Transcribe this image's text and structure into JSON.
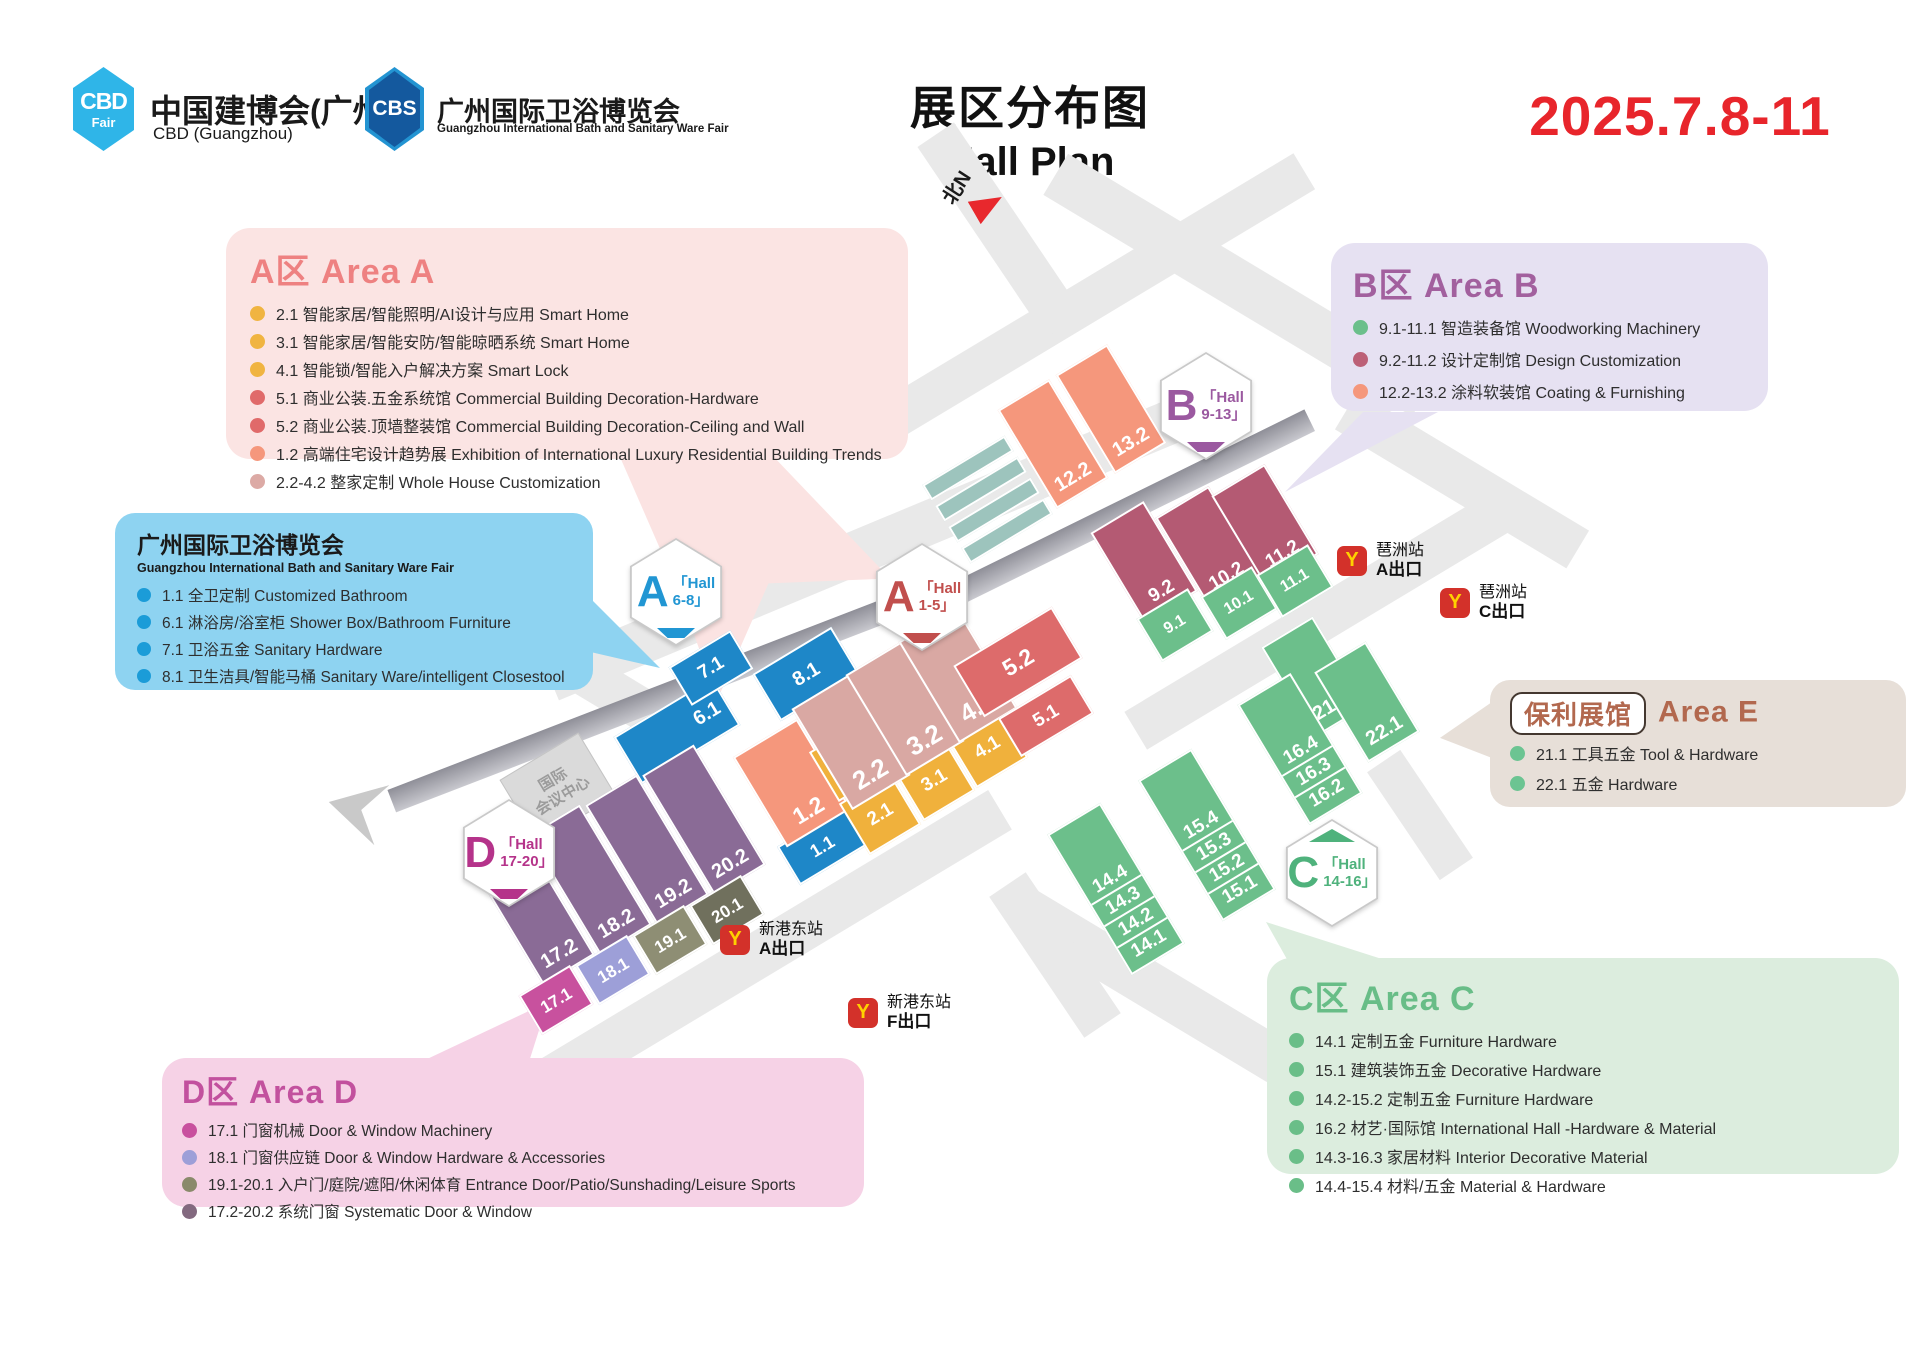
{
  "header": {
    "logo_cbd": {
      "line1": "CBD",
      "line2": "Fair",
      "title": "中国建博会(广州)",
      "subtitle": "CBD (Guangzhou)"
    },
    "logo_cbs": {
      "line1": "CBS",
      "title": "广州国际卫浴博览会",
      "subtitle": "Guangzhou International Bath and Sanitary Ware Fair"
    },
    "title_cn": "展区分布图",
    "title_en": "Hall Plan",
    "date": "2025.7.8-11"
  },
  "areas": [
    {
      "title": "A区 Area A",
      "title_color": "#ee8181",
      "bg": "#fbe4e3",
      "items": [
        {
          "dot": "#f0b441",
          "text": "2.1 智能家居/智能照明/AI设计与应用 Smart Home"
        },
        {
          "dot": "#f0b441",
          "text": "3.1 智能家居/智能安防/智能晾晒系统 Smart Home"
        },
        {
          "dot": "#f0b441",
          "text": "4.1 智能锁/智能入户解决方案 Smart Lock"
        },
        {
          "dot": "#e06a6a",
          "text": "5.1 商业公装.五金系统馆 Commercial Building Decoration-Hardware"
        },
        {
          "dot": "#e06a6a",
          "text": "5.2 商业公装.顶墙整装馆 Commercial Building Decoration-Ceiling and Wall"
        },
        {
          "dot": "#f5977c",
          "text": "1.2 高端住宅设计趋势展 Exhibition of International Luxury Residential Building Trends"
        },
        {
          "dot": "#dcaaa5",
          "text": "2.2-4.2 整家定制 Whole House Customization"
        }
      ]
    },
    {
      "title": "广州国际卫浴博览会",
      "subtitle": "Guangzhou International Bath and Sanitary Ware Fair",
      "title_color": "#1a1a1a",
      "bg": "#8ed3f1",
      "items": [
        {
          "dot": "#1b9cd8",
          "text": "1.1 全卫定制 Customized Bathroom"
        },
        {
          "dot": "#1b9cd8",
          "text": "6.1 淋浴房/浴室柜 Shower Box/Bathroom Furniture"
        },
        {
          "dot": "#1b9cd8",
          "text": "7.1 卫浴五金 Sanitary Hardware"
        },
        {
          "dot": "#1b9cd8",
          "text": "8.1 卫生洁具/智能马桶 Sanitary Ware/intelligent Closestool"
        }
      ]
    },
    {
      "title": "B区 Area B",
      "title_color": "#a2609e",
      "bg": "#e6e1f2",
      "items": [
        {
          "dot": "#6bbf8b",
          "text": "9.1-11.1 智造装备馆 Woodworking Machinery"
        },
        {
          "dot": "#bc6077",
          "text": "9.2-11.2 设计定制馆 Design Customization"
        },
        {
          "dot": "#f5977c",
          "text": "12.2-13.2 涂料软装馆 Coating & Furnishing"
        }
      ]
    },
    {
      "title": "Area E",
      "title_badge": "保利展馆",
      "title_color": "#b2684e",
      "bg": "#e7dfd8",
      "items": [
        {
          "dot": "#6cc492",
          "text": "21.1 工具五金 Tool & Hardware"
        },
        {
          "dot": "#6cc492",
          "text": "22.1 五金 Hardware"
        }
      ]
    },
    {
      "title": "C区 Area C",
      "title_color": "#68bd87",
      "bg": "#dcedde",
      "items": [
        {
          "dot": "#6abe88",
          "text": "14.1 定制五金 Furniture Hardware"
        },
        {
          "dot": "#6abe88",
          "text": "15.1 建筑装饰五金 Decorative Hardware"
        },
        {
          "dot": "#6abe88",
          "text": "14.2-15.2 定制五金 Furniture Hardware"
        },
        {
          "dot": "#6abe88",
          "text": "16.2 材艺·国际馆 International Hall -Hardware & Material"
        },
        {
          "dot": "#6abe88",
          "text": "14.3-16.3 家居材料 Interior Decorative Material"
        },
        {
          "dot": "#6abe88",
          "text": "14.4-15.4 材料/五金 Material & Hardware"
        }
      ]
    },
    {
      "title": "D区 Area D",
      "title_color": "#c2519e",
      "bg": "#f6d2e6",
      "items": [
        {
          "dot": "#c8509e",
          "text": "17.1 门窗机械  Door & Window Machinery"
        },
        {
          "dot": "#9d9fd8",
          "text": "18.1 门窗供应链  Door & Window Hardware & Accessories"
        },
        {
          "dot": "#8a8a6b",
          "text": "19.1-20.1 入户门/庭院/遮阳/休闲体育 Entrance Door/Patio/Sunshading/Leisure Sports"
        },
        {
          "dot": "#83697f",
          "text": "17.2-20.2 系统门窗 Systematic Door & Window"
        }
      ]
    }
  ],
  "map": {
    "north_label": "北N",
    "cc_line1": "国际",
    "cc_line2": "会议中心",
    "badges": [
      {
        "x": 676,
        "y": 592,
        "letter": "A",
        "l1": "「Hall",
        "l2": "6-8」",
        "color": "#2196d3",
        "marker": "bottom"
      },
      {
        "x": 922,
        "y": 597,
        "letter": "A",
        "l1": "「Hall",
        "l2": "1-5」",
        "color": "#c14f4d",
        "marker": "bottom"
      },
      {
        "x": 1206,
        "y": 406,
        "letter": "B",
        "l1": "「Hall",
        "l2": "9-13」",
        "color": "#9b59a0",
        "marker": "bottom"
      },
      {
        "x": 1332,
        "y": 873,
        "letter": "C",
        "l1": "「Hall",
        "l2": "14-16」",
        "color": "#4fb27c",
        "marker": "top"
      },
      {
        "x": 509,
        "y": 853,
        "letter": "D",
        "l1": "「Hall",
        "l2": "17-20」",
        "color": "#b5338a",
        "marker": "bottom"
      }
    ],
    "stations": [
      {
        "x": 1337,
        "y": 541,
        "name": "琶洲站",
        "exit": "A出口"
      },
      {
        "x": 1440,
        "y": 583,
        "name": "琶洲站",
        "exit": "C出口"
      },
      {
        "x": 720,
        "y": 920,
        "name": "新港东站",
        "exit": "A出口"
      },
      {
        "x": 848,
        "y": 993,
        "name": "新港东站",
        "exit": "F出口"
      }
    ],
    "halls": [
      {
        "labels": [
          "6.1"
        ],
        "x": 677,
        "y": 731,
        "w": 115,
        "h": 55,
        "c": "#1e87c8",
        "fs": 20,
        "lp": "e"
      },
      {
        "labels": [
          "7.1"
        ],
        "x": 711,
        "y": 668,
        "w": 72,
        "h": 45,
        "c": "#1e87c8",
        "fs": 19
      },
      {
        "labels": [
          "8.1"
        ],
        "x": 806,
        "y": 674,
        "w": 92,
        "h": 55,
        "c": "#1e87c8",
        "fs": 20
      },
      {
        "labels": [
          "1.1"
        ],
        "x": 822,
        "y": 846,
        "w": 78,
        "h": 45,
        "c": "#1e87c8",
        "fs": 18
      },
      {
        "labels": [
          "1.2"
        ],
        "x": 792,
        "y": 783,
        "w": 75,
        "h": 105,
        "c": "#f5977c",
        "fs": 23
      },
      {
        "labels": [],
        "x": 829,
        "y": 774,
        "w": 12,
        "h": 58,
        "c": "#f0b13c"
      },
      {
        "labels": [
          "2.1"
        ],
        "x": 880,
        "y": 814,
        "w": 60,
        "h": 60,
        "c": "#f0b13c",
        "fs": 19
      },
      {
        "labels": [
          "3.1"
        ],
        "x": 934,
        "y": 780,
        "w": 60,
        "h": 60,
        "c": "#f0b13c",
        "fs": 19
      },
      {
        "labels": [
          "4.1"
        ],
        "x": 987,
        "y": 747,
        "w": 60,
        "h": 60,
        "c": "#f0b13c",
        "fs": 19
      },
      {
        "labels": [
          "2.2"
        ],
        "x": 851,
        "y": 742,
        "w": 68,
        "h": 118,
        "c": "#d9a8a3",
        "fs": 26
      },
      {
        "labels": [
          "3.2"
        ],
        "x": 905,
        "y": 708,
        "w": 68,
        "h": 118,
        "c": "#d9a8a3",
        "fs": 26
      },
      {
        "labels": [
          "4.2"
        ],
        "x": 958,
        "y": 675,
        "w": 68,
        "h": 118,
        "c": "#d9a8a3",
        "fs": 26
      },
      {
        "labels": [
          "5.1"
        ],
        "x": 1046,
        "y": 716,
        "w": 85,
        "h": 45,
        "c": "#dd6b6b",
        "fs": 19
      },
      {
        "labels": [
          "5.2"
        ],
        "x": 1018,
        "y": 662,
        "w": 115,
        "h": 60,
        "c": "#dd6b6b",
        "fs": 23
      },
      {
        "labels": [
          "12.2"
        ],
        "x": 1053,
        "y": 444,
        "w": 60,
        "h": 115,
        "c": "#f5977c",
        "fs": 20
      },
      {
        "labels": [
          "13.2"
        ],
        "x": 1111,
        "y": 409,
        "w": 60,
        "h": 115,
        "c": "#f5977c",
        "fs": 20
      },
      {
        "labels": [
          "9.2"
        ],
        "x": 1144,
        "y": 562,
        "w": 62,
        "h": 105,
        "c": "#b45a73",
        "fs": 19
      },
      {
        "labels": [
          "10.2"
        ],
        "x": 1209,
        "y": 547,
        "w": 62,
        "h": 105,
        "c": "#b45a73",
        "fs": 19
      },
      {
        "labels": [
          "11.2"
        ],
        "x": 1265,
        "y": 525,
        "w": 62,
        "h": 105,
        "c": "#b45a73",
        "fs": 19
      },
      {
        "labels": [
          "9.1"
        ],
        "x": 1175,
        "y": 625,
        "w": 60,
        "h": 50,
        "c": "#6cbf8b",
        "fs": 16
      },
      {
        "labels": [
          "10.1"
        ],
        "x": 1239,
        "y": 603,
        "w": 60,
        "h": 50,
        "c": "#6cbf8b",
        "fs": 16
      },
      {
        "labels": [
          "11.1"
        ],
        "x": 1295,
        "y": 581,
        "w": 60,
        "h": 50,
        "c": "#6cbf8b",
        "fs": 16
      },
      {
        "labels": [
          "21.1"
        ],
        "x": 1314,
        "y": 677,
        "w": 60,
        "h": 105,
        "c": "#6cbf8b",
        "fs": 20
      },
      {
        "labels": [
          "22.1"
        ],
        "x": 1367,
        "y": 702,
        "w": 60,
        "h": 105,
        "c": "#6cbf8b",
        "fs": 20
      },
      {
        "labels": [
          "16.4",
          "16.3",
          "16.2"
        ],
        "x": 1300,
        "y": 749,
        "w": 62,
        "h": 140,
        "c": "#6cbf8b",
        "fs": 19
      },
      {
        "labels": [
          "15.4",
          "15.3",
          "15.2",
          "15.1"
        ],
        "x": 1207,
        "y": 835,
        "w": 62,
        "h": 164,
        "c": "#6cbf8b",
        "fs": 19
      },
      {
        "labels": [
          "14.4",
          "14.3",
          "14.2",
          "14.1"
        ],
        "x": 1116,
        "y": 889,
        "w": 62,
        "h": 164,
        "c": "#6cbf8b",
        "fs": 19
      },
      {
        "labels": [
          "17.2"
        ],
        "x": 533,
        "y": 910,
        "w": 60,
        "h": 140,
        "c": "#8a6b96",
        "fs": 20
      },
      {
        "labels": [
          "18.2"
        ],
        "x": 590,
        "y": 880,
        "w": 60,
        "h": 140,
        "c": "#8a6b96",
        "fs": 20
      },
      {
        "labels": [
          "19.2"
        ],
        "x": 647,
        "y": 850,
        "w": 60,
        "h": 140,
        "c": "#8a6b96",
        "fs": 20
      },
      {
        "labels": [
          "20.2"
        ],
        "x": 704,
        "y": 820,
        "w": 60,
        "h": 140,
        "c": "#8a6b96",
        "fs": 20
      },
      {
        "labels": [
          "17.1"
        ],
        "x": 556,
        "y": 1000,
        "w": 60,
        "h": 46,
        "c": "#c8519e",
        "fs": 17
      },
      {
        "labels": [
          "18.1"
        ],
        "x": 613,
        "y": 970,
        "w": 60,
        "h": 46,
        "c": "#9d9fd8",
        "fs": 17
      },
      {
        "labels": [
          "19.1"
        ],
        "x": 670,
        "y": 940,
        "w": 60,
        "h": 46,
        "c": "#8e8e74",
        "fs": 17
      },
      {
        "labels": [
          "20.1"
        ],
        "x": 727,
        "y": 910,
        "w": 60,
        "h": 46,
        "c": "#70705d",
        "fs": 17
      }
    ]
  }
}
